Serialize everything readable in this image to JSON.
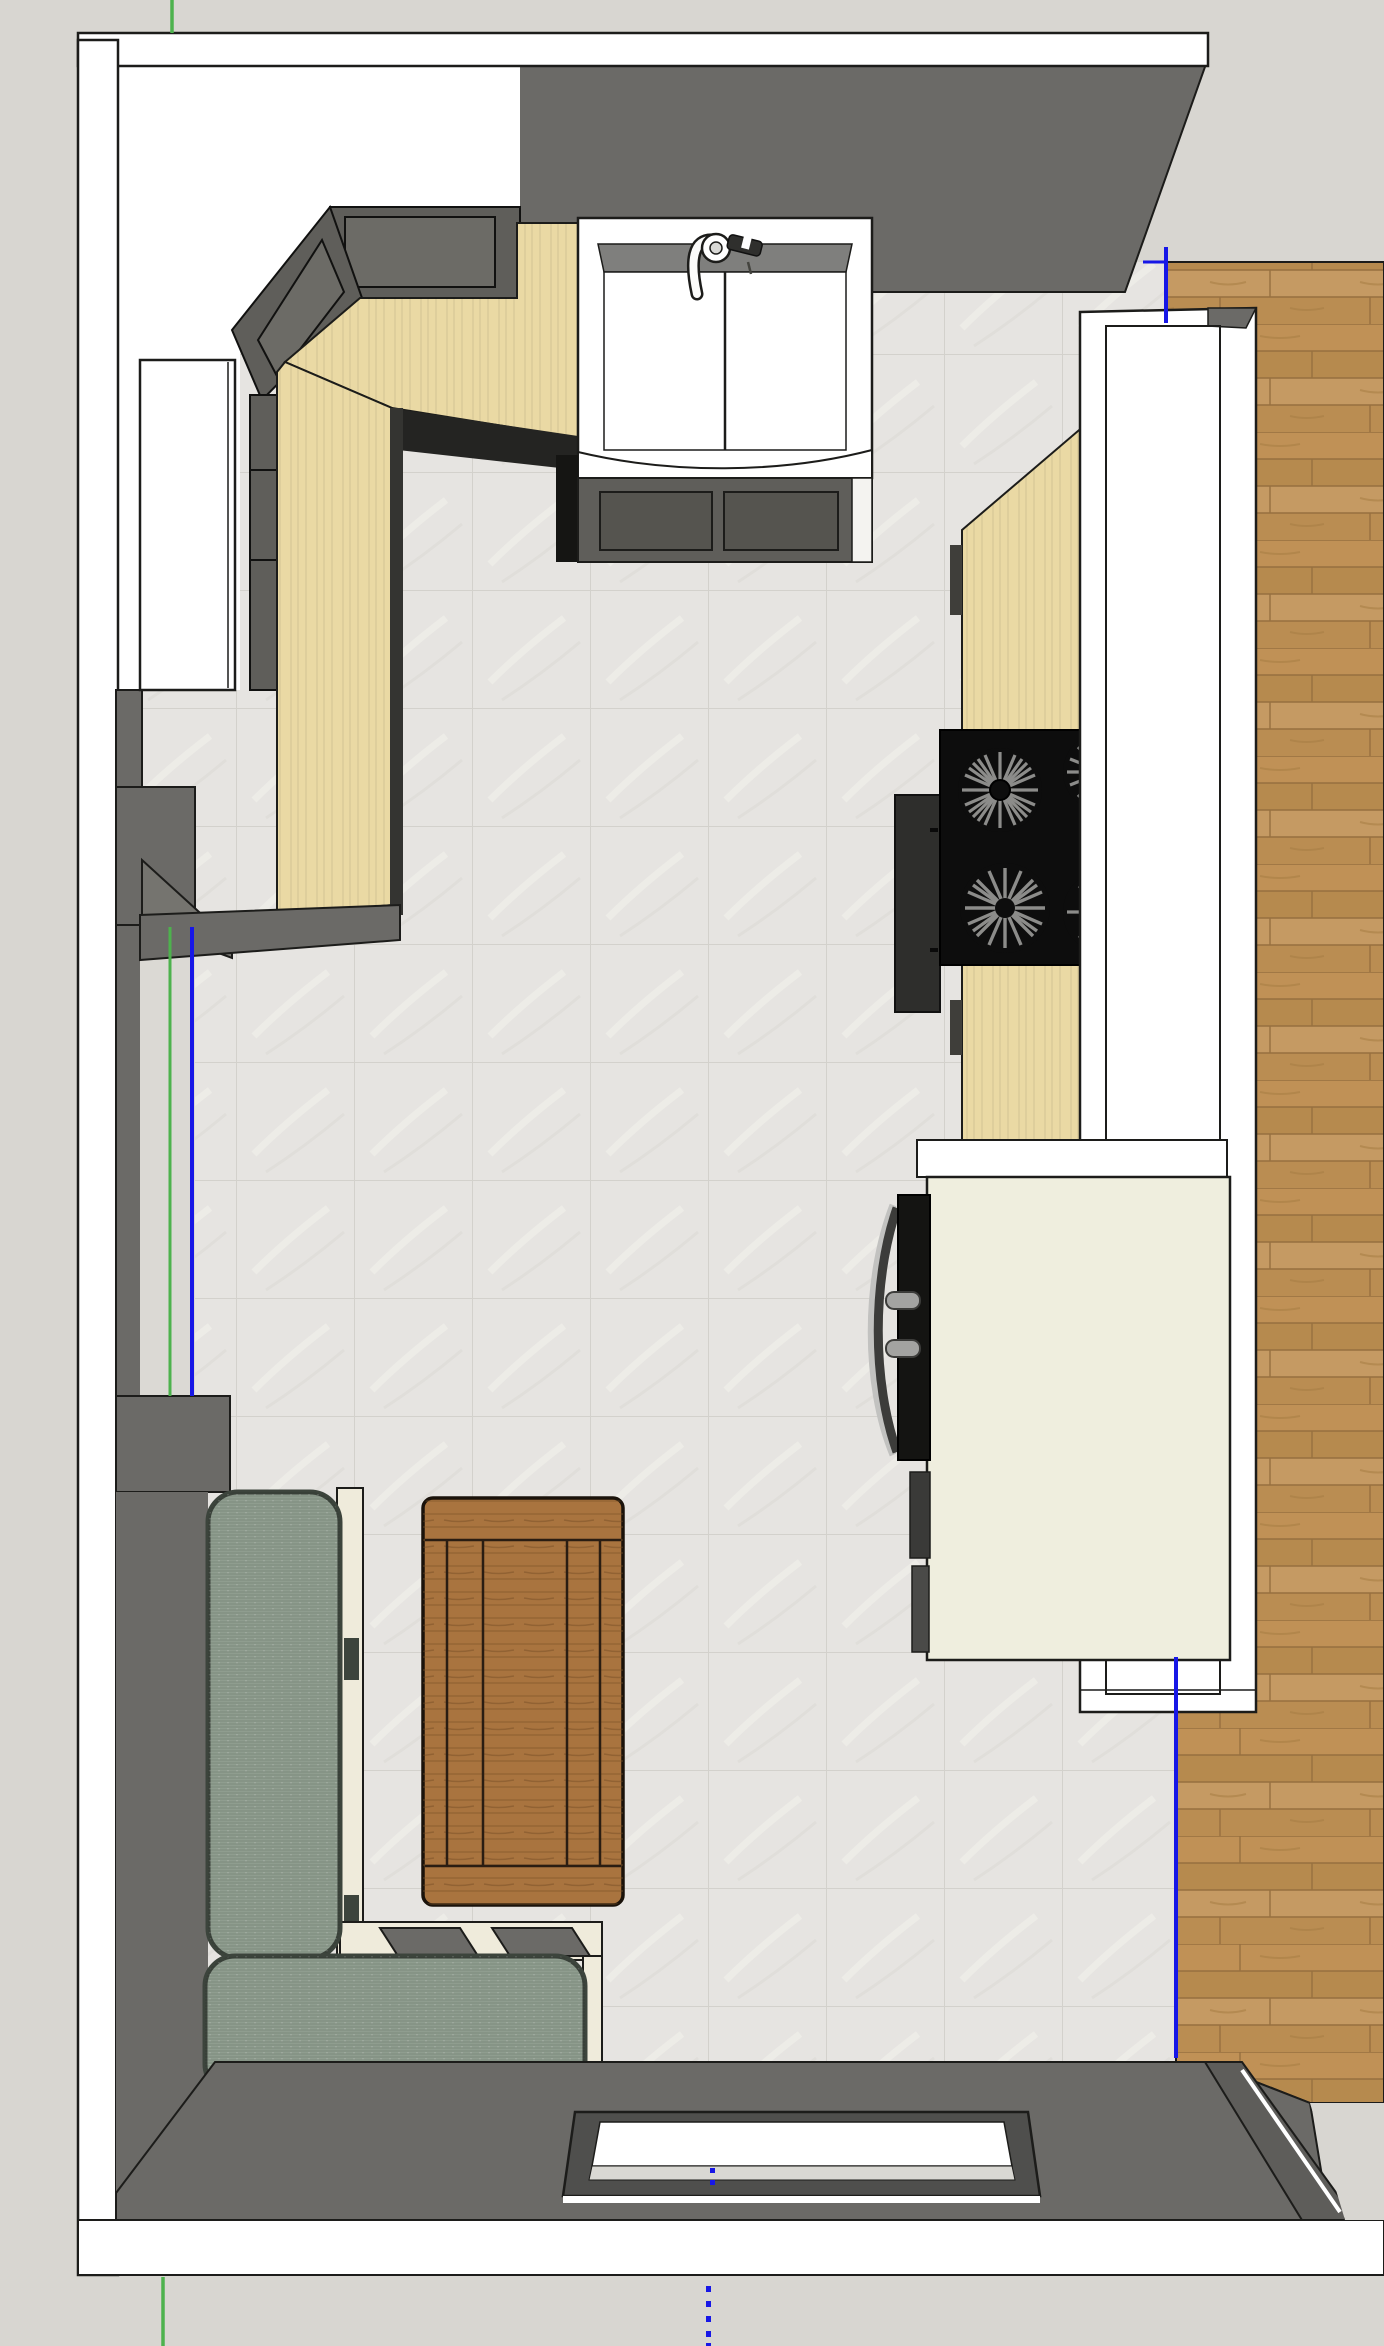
{
  "viewport": {
    "width": 1384,
    "height": 2346,
    "view": "top-down-3d-floorplan"
  },
  "colors": {
    "outside_bg": "#d8d6d1",
    "wall_white": "#ffffff",
    "wall_gray": "#6b6a67",
    "shadow_black": "#1c1c1a",
    "tile_base": "#e6e4e1",
    "wood_base": "#bd9257",
    "counter_tan": "#ead9a4",
    "cabinet_gray": "#5f5e5a",
    "cabinet_panel": "#55544f",
    "sink_white": "#ffffff",
    "sink_rim": "#7f7f7d",
    "stove_black": "#0d0d0d",
    "stove_side": "#2e2e2c",
    "burner_gray": "#8c8c8a",
    "bar_white": "#ffffff",
    "island_cream": "#efeede",
    "appliance_black": "#141412",
    "handle_gray": "#a3a3a1",
    "bench_sage": "#8f9d8f",
    "bench_outline": "#3c443c",
    "bench_frame": "#efebdb",
    "table_wood": "#a9743f",
    "table_seam": "#2a1d12",
    "window_frame": "#4f4f4d",
    "sill_gray": "#d9d8d3",
    "axis_green": "#4db24d",
    "axis_blue": "#1717e6",
    "opening_gray": "#dbd9d4"
  },
  "objects": {
    "floor_tile": "tile-floor",
    "floor_wood": "wood-floor",
    "sink": "farmhouse-double-basin-sink",
    "faucet": "kitchen-faucet",
    "cooktop": "four-burner-cooktop",
    "counters": "l-shaped-tan-countertop",
    "upper_cabinets": "dark-gray-wall-cabinets",
    "fridge": "tall-white-cabinet-top",
    "bar_wall": "white-bar-half-wall",
    "island": "cream-kitchen-island",
    "wall_oven": "black-wall-appliance",
    "bench": "l-shaped-banquette-bench",
    "table": "wood-plank-dining-table",
    "window": "bottom-wall-window",
    "door_left": "left-wall-door-opening",
    "door_right": "right-doorway-to-wood-room",
    "guides": "sketchup-axis-guides"
  }
}
